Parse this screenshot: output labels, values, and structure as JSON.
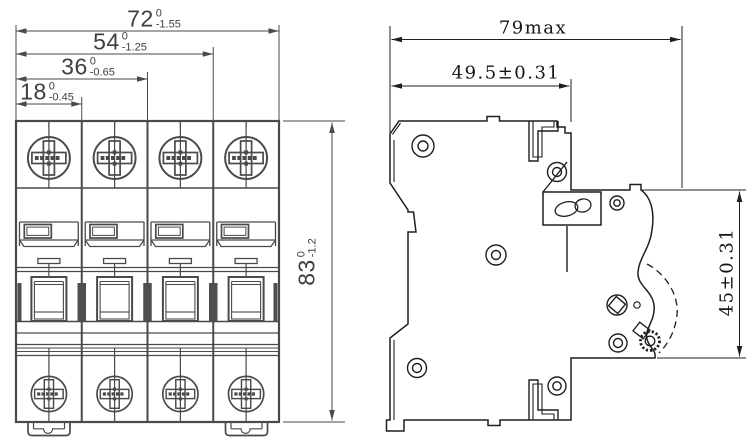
{
  "drawing": {
    "front_view": {
      "pole_count": 4,
      "dim_width_total": {
        "nominal": "72",
        "tol_upper": "0",
        "tol_lower": "-1.55"
      },
      "dim_width_3pole": {
        "nominal": "54",
        "tol_upper": "0",
        "tol_lower": "-1.25"
      },
      "dim_width_2pole": {
        "nominal": "36",
        "tol_upper": "0",
        "tol_lower": "-0.65"
      },
      "dim_width_1pole": {
        "nominal": "18",
        "tol_upper": "0",
        "tol_lower": "-0.45"
      },
      "dim_height": {
        "nominal": "83",
        "tol_upper": "0",
        "tol_lower": "-1.2"
      }
    },
    "side_view": {
      "dim_depth_max": "79max",
      "dim_depth_body": "49.5±0.31",
      "dim_front_height": "45±0.31"
    },
    "colors": {
      "line_front": "#4a4a4a",
      "line_side": "#1f1f1f",
      "fill_dark": "#4f4f4f",
      "background": "#ffffff"
    }
  }
}
